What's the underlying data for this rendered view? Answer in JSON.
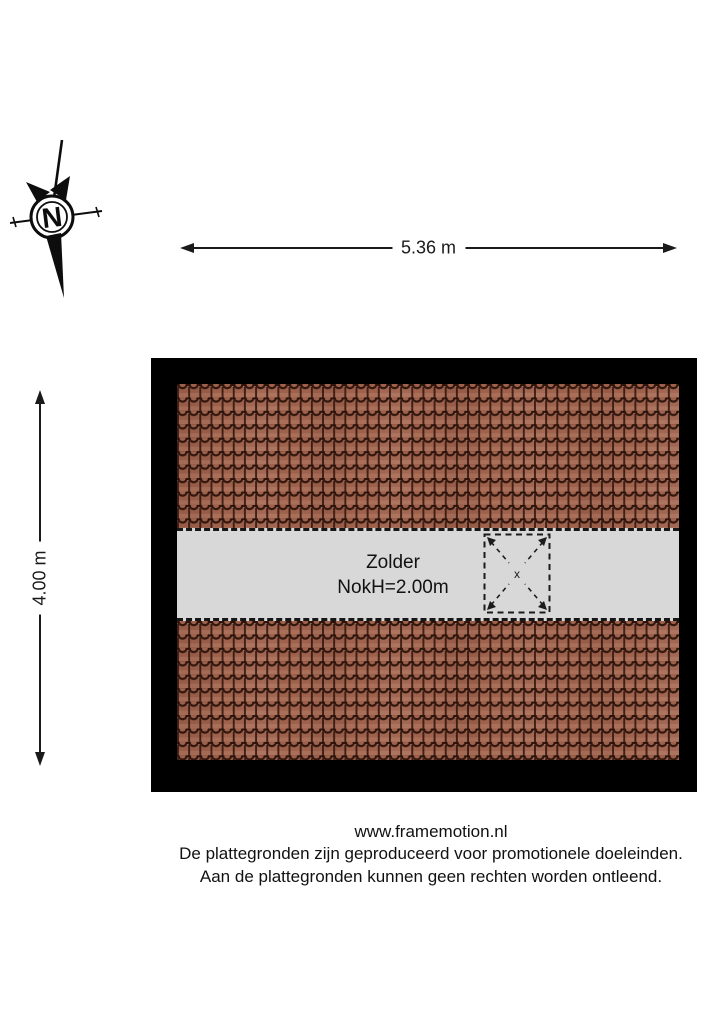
{
  "compass": {
    "north_label": "N"
  },
  "dimensions": {
    "width_label": "5.36 m",
    "height_label": "4.00 m"
  },
  "floorplan": {
    "room_name": "Zolder",
    "ridge_height_label": "NokH=2.00m",
    "skylight_marker": "x",
    "colors": {
      "wall": "#000000",
      "roof_tiles": "#9e614b",
      "roof_tile_lines": "#2e130b",
      "attic_floor": "#d8d8d8",
      "line_work": "#1a1a1a"
    }
  },
  "footer": {
    "website": "www.framemotion.nl",
    "disclaimer_line_1": "De plattegronden zijn geproduceerd voor promotionele doeleinden.",
    "disclaimer_line_2": "Aan de plattegronden kunnen geen rechten worden ontleend."
  }
}
